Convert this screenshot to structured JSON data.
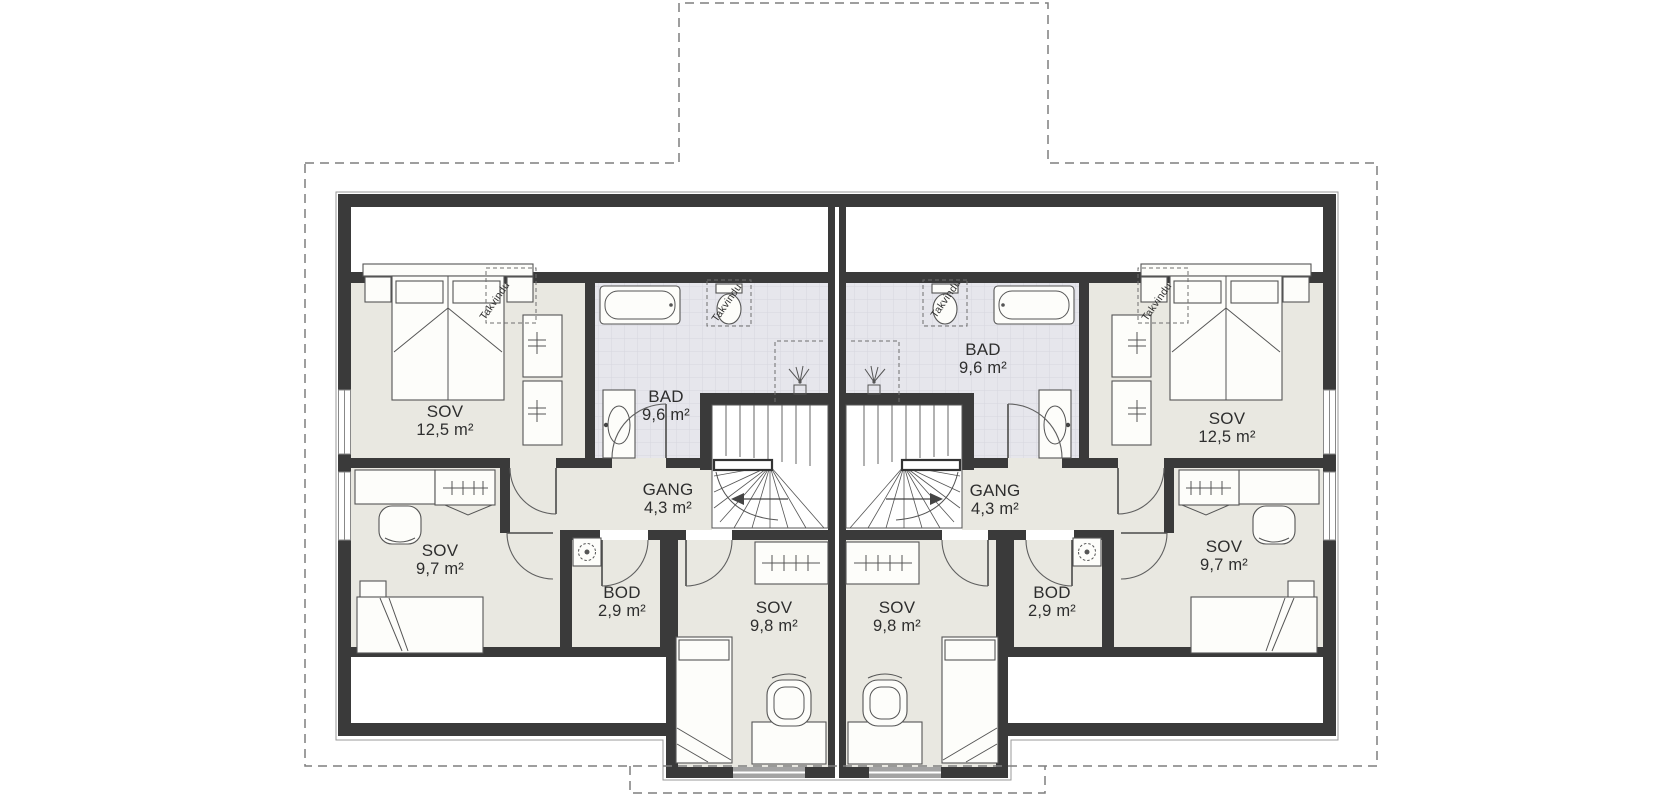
{
  "plan": {
    "type": "floor-plan",
    "units": 2,
    "mirrored": true
  },
  "colors": {
    "wall": "#3a3a3a",
    "floor": "#e9e8e1",
    "tile_floor": "#e6e6ec",
    "tile_line": "#d6d6de",
    "outline": "#999999",
    "furniture": "#555555",
    "dash": "#7f7f7f",
    "label": "#2e2e2e",
    "dormer_window": "#a3a3a3"
  },
  "rooms": [
    {
      "id": "sov-12-5-left",
      "name": "SOV",
      "area": "12,5 m²",
      "x": 445,
      "y": 421
    },
    {
      "id": "bad-left",
      "name": "BAD",
      "area": "9,6 m²",
      "x": 666,
      "y": 406
    },
    {
      "id": "gang-left",
      "name": "GANG",
      "area": "4,3 m²",
      "x": 668,
      "y": 499
    },
    {
      "id": "sov-9-7-left",
      "name": "SOV",
      "area": "9,7 m²",
      "x": 440,
      "y": 560
    },
    {
      "id": "bod-left",
      "name": "BOD",
      "area": "2,9 m²",
      "x": 622,
      "y": 602
    },
    {
      "id": "sov-9-8-left",
      "name": "SOV",
      "area": "9,8 m²",
      "x": 774,
      "y": 617
    },
    {
      "id": "sov-12-5-right",
      "name": "SOV",
      "area": "12,5 m²",
      "x": 1227,
      "y": 428
    },
    {
      "id": "bad-right",
      "name": "BAD",
      "area": "9,6 m²",
      "x": 983,
      "y": 359
    },
    {
      "id": "gang-right",
      "name": "GANG",
      "area": "4,3 m²",
      "x": 995,
      "y": 500
    },
    {
      "id": "sov-9-7-right",
      "name": "SOV",
      "area": "9,7 m²",
      "x": 1224,
      "y": 556
    },
    {
      "id": "bod-right",
      "name": "BOD",
      "area": "2,9 m²",
      "x": 1052,
      "y": 602
    },
    {
      "id": "sov-9-8-right",
      "name": "SOV",
      "area": "9,8 m²",
      "x": 897,
      "y": 617
    }
  ],
  "annotations": [
    {
      "id": "takvindu-sov-left",
      "text": "Takvindu",
      "x": 495,
      "y": 301,
      "rot": -55
    },
    {
      "id": "takvindu-bad-left",
      "text": "Takvindu",
      "x": 727,
      "y": 303,
      "rot": -55
    },
    {
      "id": "takvindu-bad-right",
      "text": "Takvindu",
      "x": 946,
      "y": 299,
      "rot": -55
    },
    {
      "id": "takvindu-sov-right",
      "text": "Takvindu",
      "x": 1157,
      "y": 302,
      "rot": -55
    }
  ]
}
